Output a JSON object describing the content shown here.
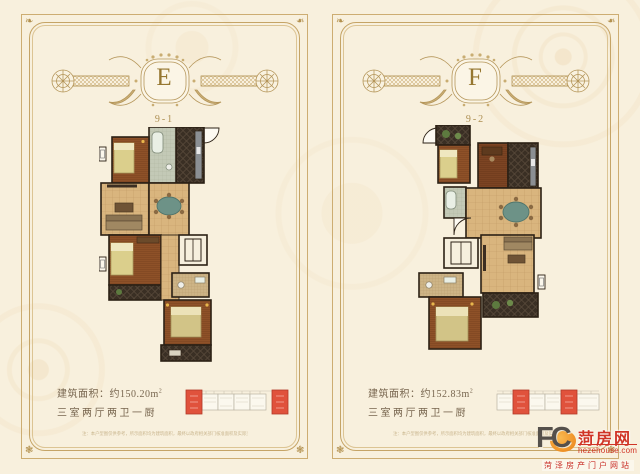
{
  "panels": [
    {
      "letter": "E",
      "unit_code": "9-1",
      "area_label": "建筑面积：约150.20m",
      "area_sup": "2",
      "layout_label": "三室两厅两卫一厨",
      "disclaimer": "注：本户型图仅供参考，所示面积均为建筑面积，最终以政府相关部门核准面积及实际交付为准，开发商保留本图的最终解释权"
    },
    {
      "letter": "F",
      "unit_code": "9-2",
      "area_label": "建筑面积：约152.83m",
      "area_sup": "2",
      "layout_label": "三室两厅两卫一厨",
      "disclaimer": "注：本户型图仅供参考，所示面积均为建筑面积，最终以政府相关部门核准面积及实际交付为准，开发商保留本图的最终解释权"
    }
  ],
  "watermark": {
    "fc": "FC",
    "brand": "菏房网",
    "domain": "hezehouse.com",
    "tagline": "菏泽房产门户网站"
  },
  "icons": {
    "corner_top": "leaf-ornament-icon",
    "corner_bottom": "shell-ornament-icon",
    "sun": "sun-icon"
  },
  "colors": {
    "background_cream": "#f8f0dd",
    "frame_gold": "#c5a466",
    "ornament_gold": "#b5965a",
    "letter_gold": "#967730",
    "text_brown": "#77654e",
    "wall_dark": "#2c2115",
    "wood_floor": "#8e5128",
    "tile_floor": "#d9b57e",
    "dark_tile": "#3a2f24",
    "keyplan_red": "#e0523c",
    "watermark_red": "#d03426"
  }
}
